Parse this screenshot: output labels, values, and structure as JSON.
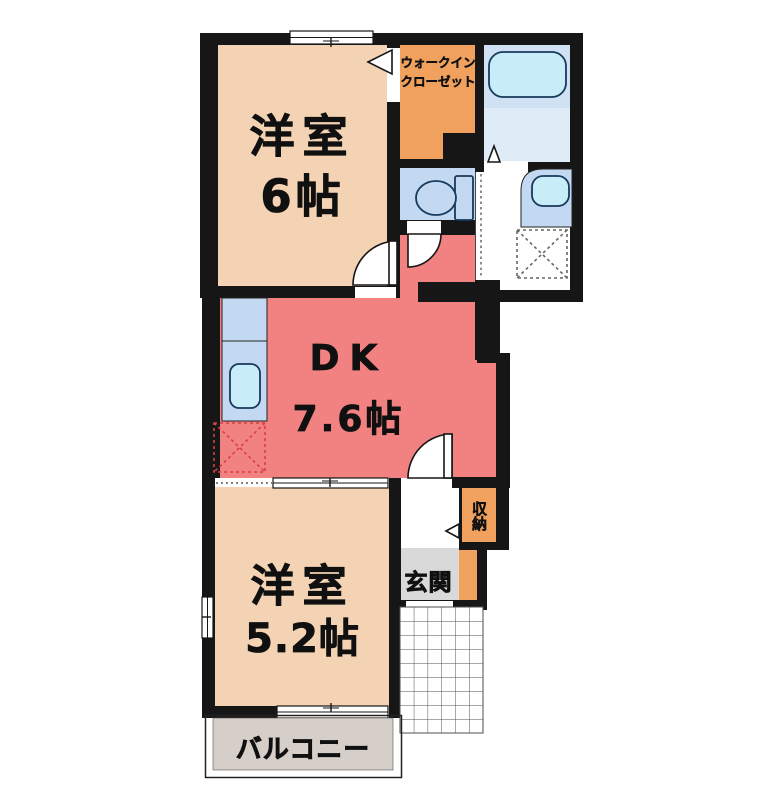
{
  "rooms": {
    "western6": {
      "name": "洋室",
      "size": "6帖"
    },
    "walk_in_closet": {
      "line1": "ウォークイン",
      "line2": "クローゼット"
    },
    "dk": {
      "name": "DK",
      "size": "7.6帖"
    },
    "western52": {
      "name": "洋室",
      "size": "5.2帖"
    },
    "storage": {
      "label": "収納"
    },
    "entrance": {
      "label": "玄関"
    },
    "balcony": {
      "label": "バルコニー"
    }
  },
  "fixtures": [
    "bathtub-icon",
    "toilet-icon",
    "vanity-sink-icon",
    "kitchen-sink-icon",
    "washing-machine-space-icon",
    "refrigerator-space-icon",
    "door-swing-icon",
    "folding-door-icon",
    "window-icon",
    "tiled-porch"
  ],
  "colors": {
    "wall": "#161616",
    "room_tan": "#f3d3b3",
    "dk_salmon": "#f28282",
    "closet_orange": "#f0a15e",
    "bath_blue": "#cfe1f3",
    "bath_blue_light": "#dfebf7",
    "fixture_blue": "#c3d9f2",
    "fixture_cyan": "#c9edf8",
    "entrance_gray": "#d9d9d9",
    "balcony_gray": "#d6cec9"
  }
}
